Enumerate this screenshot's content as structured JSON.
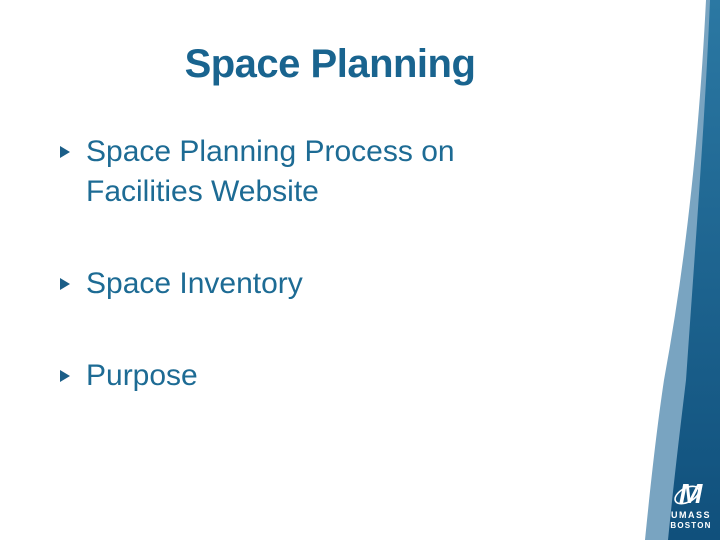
{
  "slide": {
    "title": "Space Planning",
    "bullets": [
      {
        "text": "Space Planning Process on Facilities Website"
      },
      {
        "text": "Space Inventory"
      },
      {
        "text": "Purpose"
      }
    ]
  },
  "logo": {
    "mark": "umass-m-icon",
    "line1": "UMASS",
    "line2": "BOSTON"
  },
  "colors": {
    "title_text": "#19648f",
    "body_text": "#1d6b94",
    "bullet_marker": "#1b5e88",
    "accent_dark_top": "#2b78a3",
    "accent_dark_bottom": "#10507c",
    "accent_light": "#79a4c1",
    "background": "#ffffff",
    "logo_text": "#ffffff"
  }
}
